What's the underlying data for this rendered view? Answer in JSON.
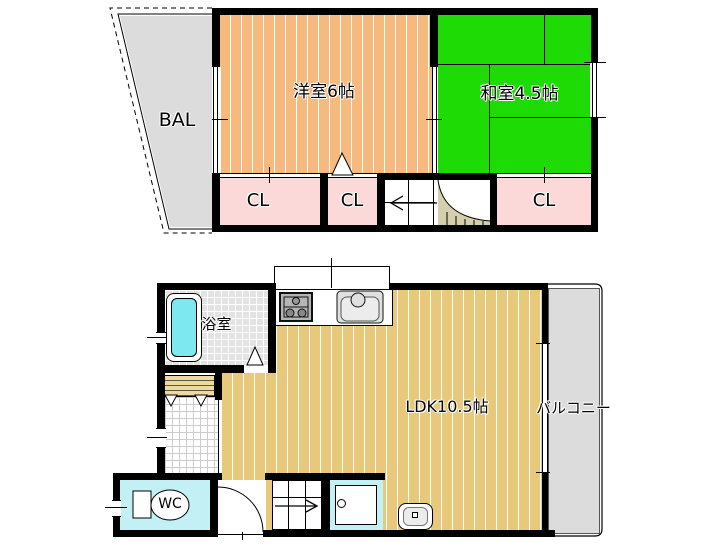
{
  "title": "apartment-floor-plan",
  "colors": {
    "wall": "#000000",
    "western_room_floor": "#f6ba7e",
    "japanese_room_tatami": "#1edb05",
    "closet": "#fbd9d9",
    "ldk_floor": "#e8c97b",
    "balcony_gray": "#dcdcdc",
    "bathtub_cyan": "#7de8f0",
    "water_area_cyan": "#c2f0f4",
    "winder_steps_beige": "#d6cfad",
    "bath_tile": "#e3e3e3"
  },
  "floor2": {
    "balcony_label": "BAL",
    "western_room_label": "洋室6帖",
    "japanese_room_label": "和室4.5帖",
    "closets": [
      "CL",
      "CL",
      "CL"
    ]
  },
  "floor1": {
    "bathroom_label": "浴室",
    "ldk_label": "LDK10.5帖",
    "balcony_label": "バルコニー",
    "toilet_label": "WC"
  },
  "icons": {
    "bathtub": "bathtub-icon",
    "toilet": "toilet-icon",
    "gas_stove": "gas-stove-icon",
    "kitchen_sink": "kitchen-sink-icon",
    "washer_pan": "washer-pan-icon",
    "basin": "basin-icon",
    "stairs_up_arrow": "stairs-arrow-icon",
    "door_swing": "door-swing-arc-icon",
    "door_triangle": "door-triangle-icon"
  }
}
